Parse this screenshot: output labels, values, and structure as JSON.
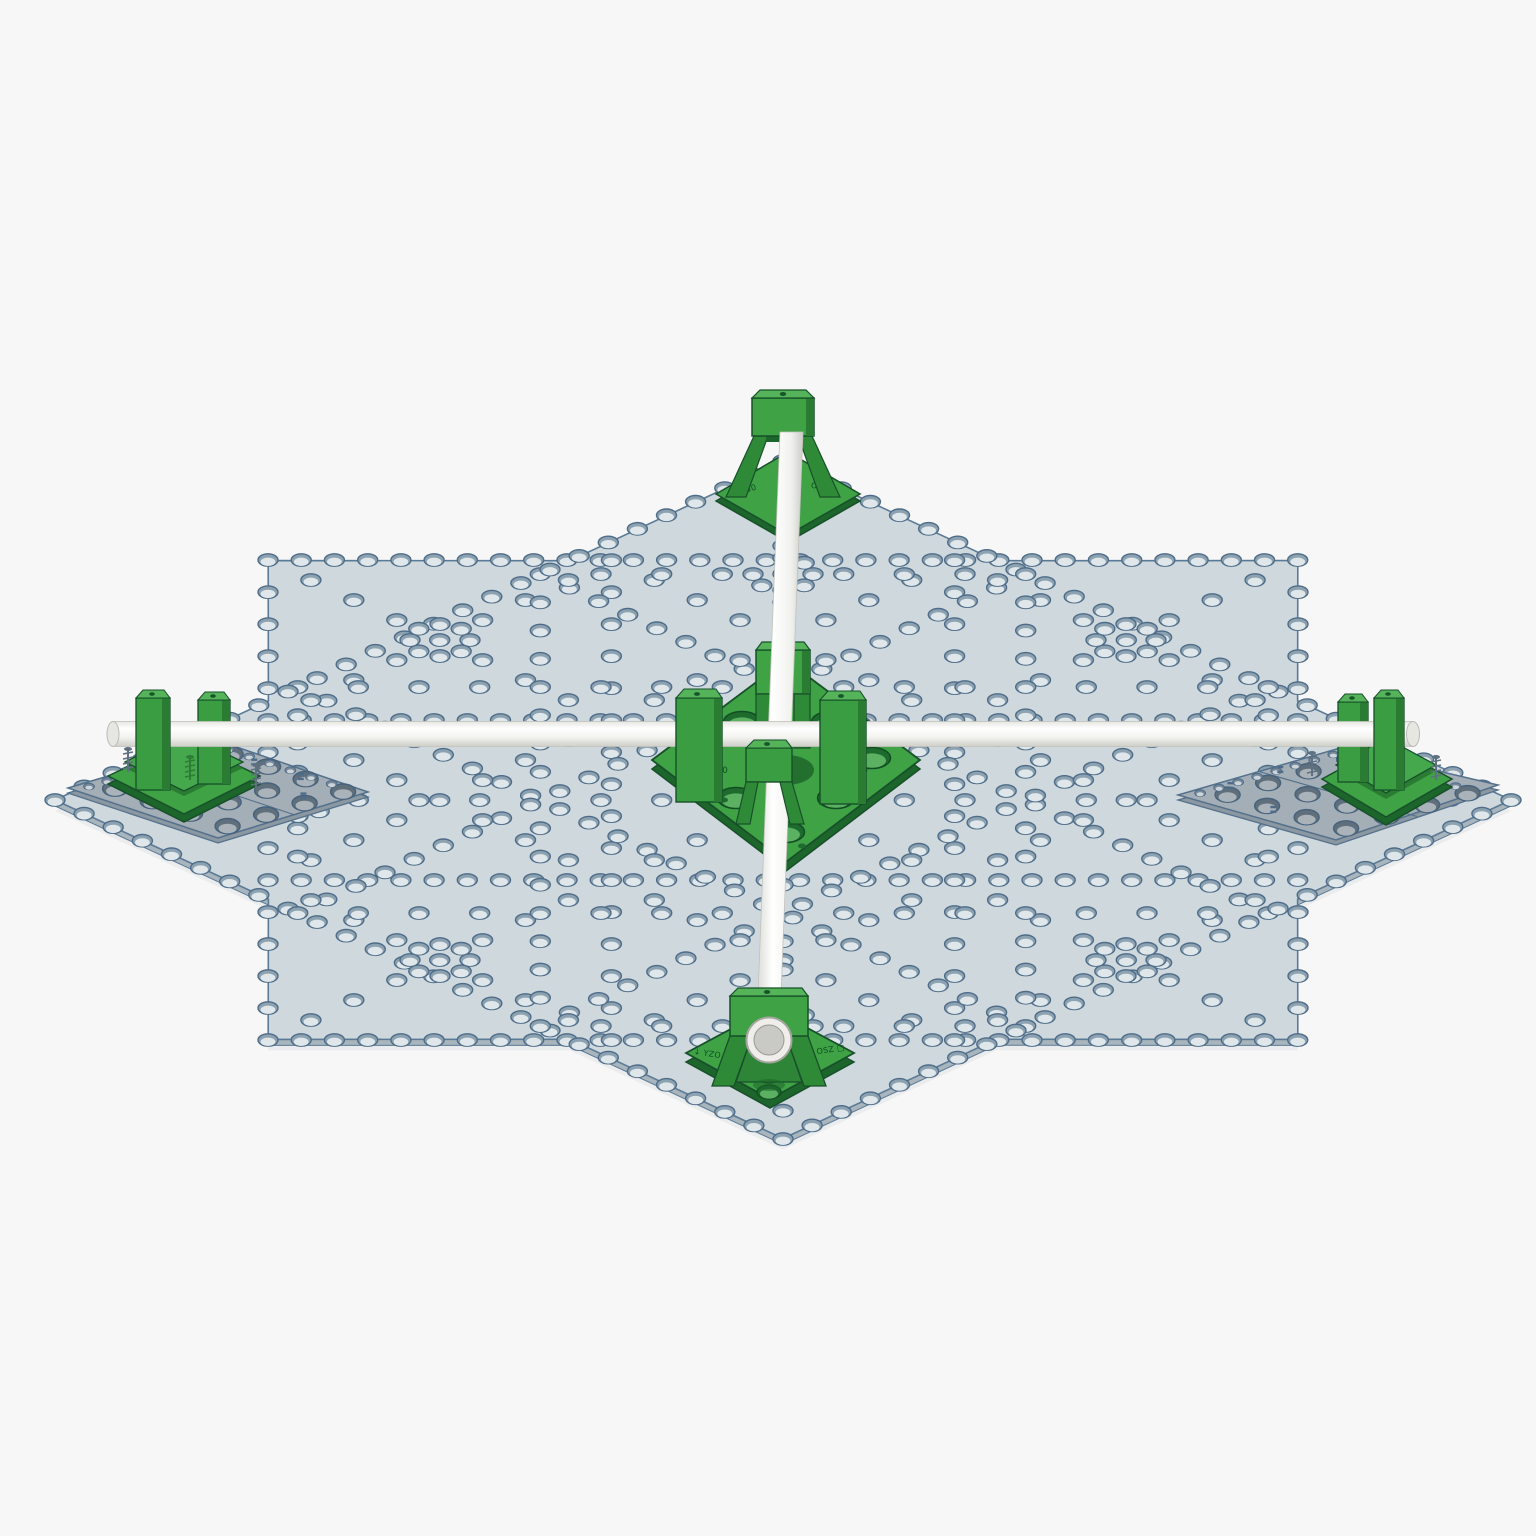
{
  "scene": {
    "background": "#f7f7f7",
    "parts": {
      "mount_top": {
        "markings": [
          "□ 250",
          "OZA ↑"
        ]
      },
      "mount_center": {
        "markings": [
          "□ 250",
          "□ 250"
        ]
      },
      "mount_bottom": {
        "markings": [
          "↓ YZO",
          "OSZ □"
        ]
      }
    }
  },
  "palette": {
    "plateFace": "#cfd8dd",
    "plateSide": "#a9b5bd",
    "plateOutline": "#5a7a96",
    "plateShadow": "#eaecee",
    "subPlateFace": "#a4aeb6",
    "subPlateSide": "#8c98a1",
    "subPlateOutline": "#54718c",
    "greenFace": "#3fa245",
    "greenTop": "#55b35a",
    "greenSide": "#2a7c33",
    "greenLeg": "#2f8a38",
    "greenDark": "#1d662b",
    "greenOutline": "#17502a",
    "rodLight": "#ffffff",
    "rodMid": "#f3f3f0",
    "rodShade": "#d2d2cc",
    "rodEdge": "#c2c2bc",
    "boltGray": "#5f7180",
    "markBlue": "#4e6c88"
  },
  "holes": {
    "gray": {
      "rx": 10,
      "ry": 6.2,
      "rim": "#8da2b1",
      "stroke": "#4e6c88",
      "sw": 1.4,
      "dy": 1.8,
      "rx2": 7.4,
      "ry2": 4.2,
      "inner": "#dfe7ea"
    },
    "big": {
      "rx": 12.5,
      "ry": 7.6,
      "rim": "#5f6f7b",
      "stroke": "#46627c",
      "sw": 1.4,
      "dy": 2.4,
      "rx2": 9,
      "ry2": 4.8,
      "inner": "#aab3ba"
    },
    "small": {
      "rx": 5.4,
      "ry": 3.3,
      "rim": "#76879a",
      "stroke": "#4e6c88",
      "sw": 1,
      "dy": 1.2,
      "rx2": 3.6,
      "ry2": 2,
      "inner": "#ccd4d9"
    },
    "green": {
      "rx": 18.5,
      "ry": 10.5,
      "rim": "#1e6b2e",
      "stroke": "#134d23",
      "sw": 1.5,
      "dy": 2.6,
      "rx2": 14,
      "ry2": 7.2,
      "inner": "#5cb062"
    }
  },
  "star": {
    "cx": 783,
    "cy": 800,
    "outerRx": 728,
    "outerRy": 338.5,
    "innerRx": 557,
    "innerRy": 259,
    "sq1": {
      "ax": 515,
      "ay": 240
    },
    "sq2": {
      "ax": 364,
      "ay": 169.5
    },
    "gridLines": [
      -1,
      -0.3333,
      0.3333,
      1
    ],
    "step1h": 0.0645,
    "step1v": 0.1333,
    "step2": 0.08,
    "diagSteps": 7,
    "ringCenters": [
      [
        440,
        640
      ],
      [
        1126,
        640
      ],
      [
        440,
        960
      ],
      [
        1126,
        960
      ],
      [
        783,
        574
      ],
      [
        783,
        1026
      ],
      [
        298,
        800
      ],
      [
        1268,
        800
      ]
    ],
    "ringRx": 30,
    "ringRy": 16,
    "ringPoints": 8
  },
  "subPlates": {
    "left": {
      "W": [
        68,
        788
      ],
      "N": [
        222,
        742
      ],
      "E": [
        368,
        792
      ],
      "S": [
        218,
        838
      ]
    },
    "right": {
      "W": [
        1178,
        795
      ],
      "N": [
        1340,
        748
      ],
      "E": [
        1498,
        785
      ],
      "S": [
        1336,
        840
      ]
    },
    "eqMarks": [
      [
        1.05,
        0.25
      ],
      [
        2.35,
        0.18
      ],
      [
        3.62,
        1.25
      ],
      [
        3.66,
        2.45
      ],
      [
        0.55,
        1.85
      ],
      [
        2.9,
        3.3
      ]
    ]
  },
  "centerPlate": {
    "bigHoles": [
      [
        700,
        758
      ],
      [
        872,
        758
      ],
      [
        742,
        722
      ],
      [
        830,
        722
      ],
      [
        736,
        798
      ],
      [
        836,
        798
      ],
      [
        786,
        832
      ]
    ],
    "boltDots": [
      [
        706,
        736
      ],
      [
        720,
        730
      ],
      [
        852,
        736
      ],
      [
        866,
        730
      ],
      [
        712,
        790
      ],
      [
        724,
        800
      ],
      [
        848,
        790
      ],
      [
        860,
        800
      ],
      [
        770,
        846
      ],
      [
        802,
        846
      ]
    ]
  },
  "bottomPlate": {
    "holes": [
      [
        769,
        1076
      ],
      [
        769,
        1092
      ]
    ]
  },
  "springsGray": [
    [
      128,
      762
    ],
    [
      256,
      778
    ],
    [
      1312,
      766
    ],
    [
      1436,
      770
    ]
  ],
  "springsGreen": [
    [
      190,
      770
    ]
  ]
}
